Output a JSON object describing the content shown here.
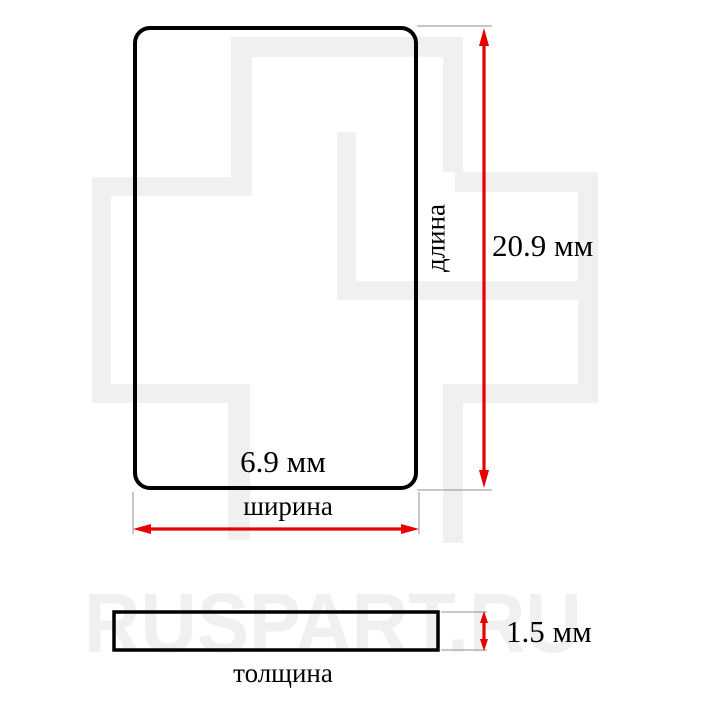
{
  "diagram": {
    "front_view": {
      "length_value": "20.9 мм",
      "length_caption": "длина",
      "width_value": "6.9 мм",
      "width_caption": "ширина"
    },
    "side_view": {
      "thickness_value": "1.5 мм",
      "thickness_caption": "толщина"
    }
  },
  "watermark": {
    "text": "RUSPART.RU"
  },
  "colors": {
    "dimension_arrow": "#e60000",
    "outline": "#000000",
    "extension_line": "#909090",
    "watermark": "#f0f0f0"
  }
}
